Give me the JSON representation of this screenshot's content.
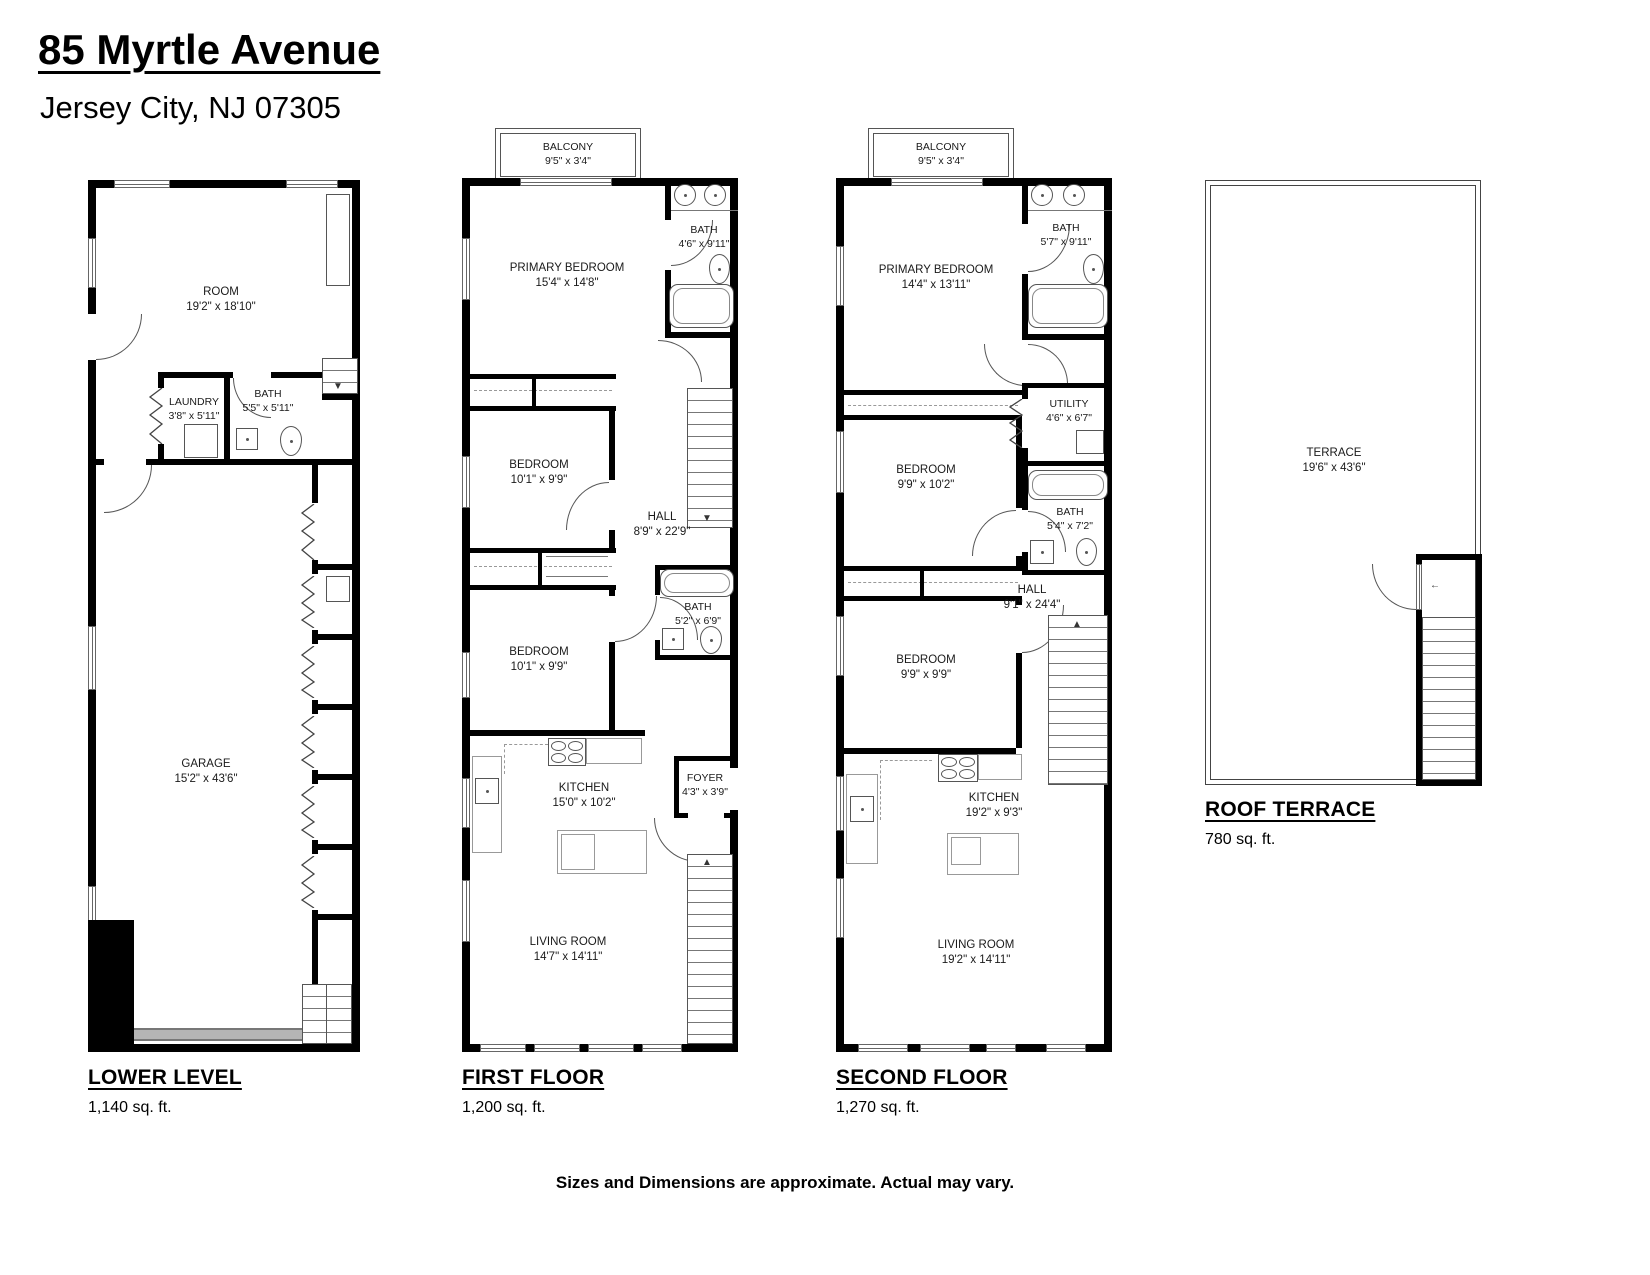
{
  "title": {
    "address": "85 Myrtle Avenue",
    "city_line": "Jersey City, NJ 07305"
  },
  "colors": {
    "wall": "#000000",
    "background": "#ffffff"
  },
  "floors": {
    "lower": {
      "label": "LOWER LEVEL",
      "sqft": "1,140 sq. ft.",
      "rooms": {
        "room": {
          "name": "ROOM",
          "dims": "19'2\" x 18'10\""
        },
        "laundry": {
          "name": "LAUNDRY",
          "dims": "3'8\" x 5'11\""
        },
        "bath": {
          "name": "BATH",
          "dims": "5'5\" x 5'11\""
        },
        "garage": {
          "name": "GARAGE",
          "dims": "15'2\" x 43'6\""
        }
      }
    },
    "first": {
      "label": "FIRST FLOOR",
      "sqft": "1,200 sq. ft.",
      "rooms": {
        "balcony": {
          "name": "BALCONY",
          "dims": "9'5\" x 3'4\""
        },
        "primary_bedroom": {
          "name": "PRIMARY BEDROOM",
          "dims": "15'4\" x 14'8\""
        },
        "bath_top": {
          "name": "BATH",
          "dims": "4'6\" x 9'11\""
        },
        "bedroom_mid": {
          "name": "BEDROOM",
          "dims": "10'1\" x 9'9\""
        },
        "hall": {
          "name": "HALL",
          "dims": "8'9\" x 22'9\""
        },
        "bedroom_low": {
          "name": "BEDROOM",
          "dims": "10'1\" x 9'9\""
        },
        "bath_mid": {
          "name": "BATH",
          "dims": "5'2\" x 6'9\""
        },
        "kitchen": {
          "name": "KITCHEN",
          "dims": "15'0\" x 10'2\""
        },
        "foyer": {
          "name": "FOYER",
          "dims": "4'3\" x 3'9\""
        },
        "living_room": {
          "name": "LIVING ROOM",
          "dims": "14'7\" x 14'11\""
        }
      }
    },
    "second": {
      "label": "SECOND FLOOR",
      "sqft": "1,270 sq. ft.",
      "rooms": {
        "balcony": {
          "name": "BALCONY",
          "dims": "9'5\" x 3'4\""
        },
        "primary_bedroom": {
          "name": "PRIMARY BEDROOM",
          "dims": "14'4\" x 13'11\""
        },
        "bath_top": {
          "name": "BATH",
          "dims": "5'7\" x 9'11\""
        },
        "utility": {
          "name": "UTILITY",
          "dims": "4'6\" x 6'7\""
        },
        "bedroom_mid": {
          "name": "BEDROOM",
          "dims": "9'9\" x 10'2\""
        },
        "bath_mid": {
          "name": "BATH",
          "dims": "5'4\" x 7'2\""
        },
        "hall": {
          "name": "HALL",
          "dims": "9'1\" x 24'4\""
        },
        "bedroom_low": {
          "name": "BEDROOM",
          "dims": "9'9\" x 9'9\""
        },
        "kitchen": {
          "name": "KITCHEN",
          "dims": "19'2\" x 9'3\""
        },
        "living_room": {
          "name": "LIVING ROOM",
          "dims": "19'2\" x 14'11\""
        }
      }
    },
    "roof": {
      "label": "ROOF TERRACE",
      "sqft": "780 sq. ft.",
      "rooms": {
        "terrace": {
          "name": "TERRACE",
          "dims": "19'6\" x 43'6\""
        }
      }
    }
  },
  "footer": {
    "disclaimer": "Sizes and Dimensions are approximate. Actual may vary."
  }
}
